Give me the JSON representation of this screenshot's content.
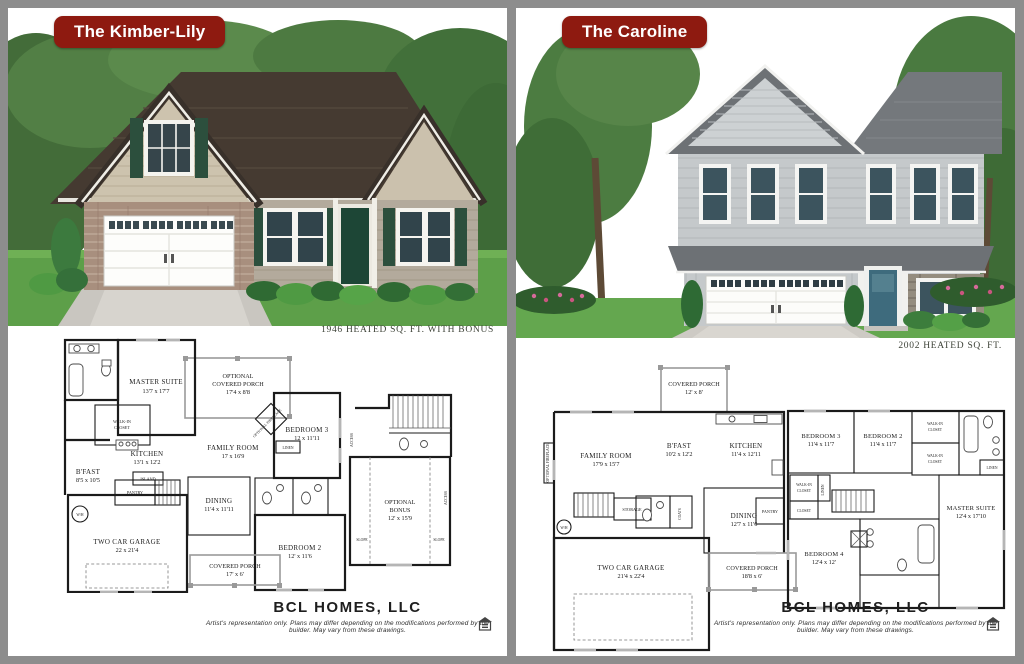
{
  "left": {
    "title": "The Kimber-Lily",
    "sqft": "1946 HEATED SQ. FT. WITH BONUS",
    "rooms": {
      "master": {
        "name": "MASTER SUITE",
        "dims": "13'7 x 17'7"
      },
      "opt_porch": {
        "l1": "OPTIONAL",
        "l2": "COVERED PORCH",
        "dims": "17'4 x 8'8"
      },
      "walkin": {
        "l1": "WALK-IN",
        "l2": "CLOSET"
      },
      "kitchen": {
        "name": "KITCHEN",
        "dims": "13'1 x 12'2"
      },
      "island": {
        "name": "ISLAND"
      },
      "bfast": {
        "name": "B'FAST",
        "dims": "8'5 x 10'5"
      },
      "family": {
        "name": "FAMILY ROOM",
        "dims": "17 x 16'9"
      },
      "bed3": {
        "name": "BEDROOM 3",
        "dims": "12 x 11'11"
      },
      "fireplace": {
        "name": "OPTIONAL FIREPLACE"
      },
      "linen": {
        "name": "LINEN"
      },
      "pantry": {
        "name": "PANTRY"
      },
      "wh": {
        "name": "W/H"
      },
      "dining": {
        "name": "DINING",
        "dims": "11'4 x 11'11"
      },
      "garage": {
        "name": "TWO CAR GARAGE",
        "dims": "22 x 21'4"
      },
      "bed2": {
        "name": "BEDROOM 2",
        "dims": "12' x 11'6"
      },
      "porch": {
        "name": "COVERED PORCH",
        "dims": "17' x 6'"
      },
      "bonus": {
        "l1": "OPTIONAL",
        "l2": "BONUS",
        "dims": "12' x 15'9"
      },
      "slope": {
        "name": "SLOPE"
      },
      "access": {
        "name": "ACCESS"
      }
    }
  },
  "right": {
    "title": "The Caroline",
    "sqft": "2002 HEATED SQ. FT.",
    "first": {
      "porch_top": {
        "name": "COVERED PORCH",
        "dims": "12' x 8'"
      },
      "family": {
        "name": "FAMILY ROOM",
        "dims": "17'9 x 15'7"
      },
      "fireplace": {
        "name": "OPTIONAL FIREPLACE"
      },
      "bfast": {
        "name": "B'FAST",
        "dims": "10'2 x 12'2"
      },
      "kitchen": {
        "name": "KITCHEN",
        "dims": "11'4 x 12'11"
      },
      "coats": {
        "name": "COATS"
      },
      "storage": {
        "name": "STORAGE"
      },
      "wh": {
        "name": "W/H"
      },
      "pantry": {
        "name": "PANTRY"
      },
      "dining": {
        "name": "DINING",
        "dims": "12'7 x 11'6"
      },
      "garage": {
        "name": "TWO CAR GARAGE",
        "dims": "21'4 x 22'4"
      },
      "porch_bottom": {
        "name": "COVERED PORCH",
        "dims": "18'8 x 6'"
      }
    },
    "second": {
      "bed3": {
        "name": "BEDROOM 3",
        "dims": "11'4 x 11'7"
      },
      "bed2": {
        "name": "BEDROOM 2",
        "dims": "11'4 x 11'7"
      },
      "walkin": {
        "l1": "WALK-IN",
        "l2": "CLOSET"
      },
      "linen": {
        "name": "LINEN"
      },
      "master": {
        "name": "MASTER SUITE",
        "dims": "12'4 x 17'10"
      },
      "closet": {
        "name": "CLOSET"
      },
      "bed4": {
        "name": "BEDROOM 4",
        "dims": "12'4 x 12'"
      }
    }
  },
  "footer": {
    "brand": "BCL HOMES, LLC",
    "disclaimer": "Artist's representation only. Plans may differ depending on the modifications performed by the builder. May vary from these drawings."
  },
  "colors": {
    "badge_red": "#8e1a10",
    "kimber_roof": "#453a31",
    "kimber_siding": "#b3aa9c",
    "kimber_shutters": "#2c4f3d",
    "caroline_roof": "#6d7175",
    "caroline_siding": "#c5c9cb",
    "caroline_door": "#3e6b7d"
  }
}
